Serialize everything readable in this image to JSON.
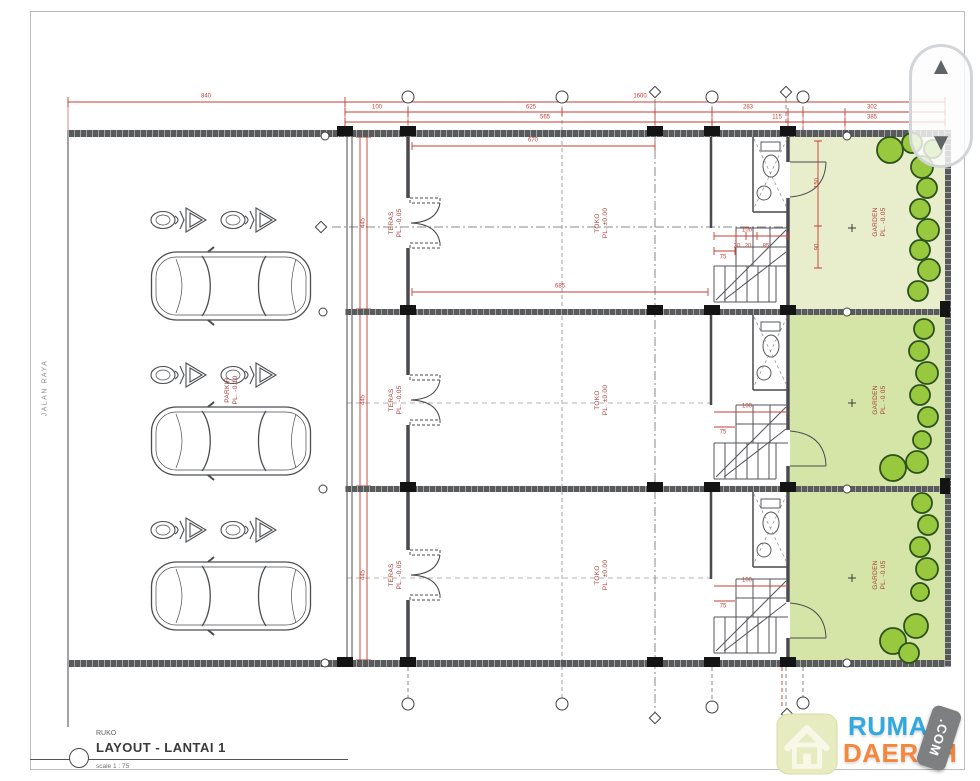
{
  "document": {
    "type": "architectural floor plan",
    "sheet_background": "#ffffff"
  },
  "scrollbar": {
    "up_icon": "▲",
    "down_icon": "▼"
  },
  "title_block": {
    "project": "RUKO",
    "title": "LAYOUT - LANTAI 1",
    "scale": "scale 1 : 75"
  },
  "logo": {
    "word1": "RUMAH",
    "word2": "DAERAH",
    "tag": ".COM",
    "colors": {
      "word1": "#31a9e0",
      "word2": "#f5863c",
      "tag_bg": "#7d7f80",
      "house_tile": "#e6ebc0"
    }
  },
  "plan": {
    "colors": {
      "wall": "#595a5c",
      "dimension_red": "#c43d33",
      "room_label_red": "#a8403a",
      "garden_light": "#e8eecb",
      "garden": "#d5e5a8",
      "bush_fill": "#97c83e",
      "bush_outline": "#2d521d"
    },
    "annotations": [
      {
        "name": "road-label",
        "cls": "road",
        "text": "JALAN RAYA",
        "x": 46,
        "y": 388,
        "rot": -90
      },
      {
        "name": "room-label-teras-1",
        "cls": "room",
        "text": "TERAS\nPL. -0.05",
        "x": 396,
        "y": 223,
        "rot": -90
      },
      {
        "name": "room-label-teras-2",
        "cls": "room",
        "text": "TERAS\nPL. -0.05",
        "x": 396,
        "y": 400,
        "rot": -90
      },
      {
        "name": "room-label-teras-3",
        "cls": "room",
        "text": "TERAS\nPL. -0.05",
        "x": 396,
        "y": 575,
        "rot": -90
      },
      {
        "name": "room-label-toko-1",
        "cls": "room",
        "text": "TOKO\nPL. ±0.00",
        "x": 602,
        "y": 223,
        "rot": -90
      },
      {
        "name": "room-label-toko-2",
        "cls": "room",
        "text": "TOKO\nPL. ±0.00",
        "x": 602,
        "y": 400,
        "rot": -90
      },
      {
        "name": "room-label-toko-3",
        "cls": "room",
        "text": "TOKO\nPL. ±0.00",
        "x": 602,
        "y": 575,
        "rot": -90
      },
      {
        "name": "room-label-garden-1",
        "cls": "room",
        "text": "GARDEN\nPL. -0.05",
        "x": 880,
        "y": 222,
        "rot": -90
      },
      {
        "name": "room-label-garden-2",
        "cls": "room",
        "text": "GARDEN\nPL. -0.05",
        "x": 880,
        "y": 400,
        "rot": -90
      },
      {
        "name": "room-label-garden-3",
        "cls": "room",
        "text": "GARDEN\nPL. -0.05",
        "x": 880,
        "y": 575,
        "rot": -90
      },
      {
        "name": "room-label-parkir",
        "cls": "room",
        "text": "PARKIR\nPL. -0.10",
        "x": 232,
        "y": 390,
        "rot": -90
      },
      {
        "name": "dim-840",
        "cls": "dim",
        "text": "840",
        "x": 206,
        "y": 97,
        "rot": 0
      },
      {
        "name": "dim-1600",
        "cls": "dim",
        "text": "1600",
        "x": 640,
        "y": 97,
        "rot": 0
      },
      {
        "name": "dim-100",
        "cls": "dim",
        "text": "100",
        "x": 377,
        "y": 108,
        "rot": 0
      },
      {
        "name": "dim-625",
        "cls": "dim",
        "text": "625",
        "x": 531,
        "y": 108,
        "rot": 0
      },
      {
        "name": "dim-283",
        "cls": "dim",
        "text": "283",
        "x": 748,
        "y": 108,
        "rot": 0
      },
      {
        "name": "dim-302",
        "cls": "dim",
        "text": "302",
        "x": 872,
        "y": 108,
        "rot": 0
      },
      {
        "name": "dim-565",
        "cls": "dim",
        "text": "565",
        "x": 545,
        "y": 118,
        "rot": 0
      },
      {
        "name": "dim-115",
        "cls": "dim",
        "text": "115",
        "x": 777,
        "y": 118,
        "rot": 0
      },
      {
        "name": "dim-385",
        "cls": "dim",
        "text": "385",
        "x": 872,
        "y": 118,
        "rot": 0
      },
      {
        "name": "dim-670",
        "cls": "dim",
        "text": "670",
        "x": 533,
        "y": 141,
        "rot": 0
      },
      {
        "name": "dim-685",
        "cls": "dim",
        "text": "685",
        "x": 560,
        "y": 287,
        "rot": 0
      },
      {
        "name": "dim-445-1",
        "cls": "dim",
        "text": "445",
        "x": 364,
        "y": 223,
        "rot": -90
      },
      {
        "name": "dim-445-2",
        "cls": "dim",
        "text": "445",
        "x": 364,
        "y": 400,
        "rot": -90
      },
      {
        "name": "dim-445-3",
        "cls": "dim",
        "text": "445",
        "x": 364,
        "y": 575,
        "rot": -90
      },
      {
        "name": "dim-stair1-100",
        "cls": "dim",
        "text": "100",
        "x": 747,
        "y": 231,
        "rot": 0
      },
      {
        "name": "dim-stair1-20a",
        "cls": "dim",
        "text": "20",
        "x": 737,
        "y": 247,
        "rot": 0
      },
      {
        "name": "dim-stair1-20b",
        "cls": "dim",
        "text": "20",
        "x": 748,
        "y": 247,
        "rot": 0
      },
      {
        "name": "dim-stair1-85",
        "cls": "dim",
        "text": "85",
        "x": 766,
        "y": 247,
        "rot": 0
      },
      {
        "name": "dim-stair1-75",
        "cls": "dim",
        "text": "75",
        "x": 723,
        "y": 258,
        "rot": 0
      },
      {
        "name": "dim-garden1-150",
        "cls": "dim",
        "text": "150",
        "x": 818,
        "y": 183,
        "rot": -90
      },
      {
        "name": "dim-garden1-90",
        "cls": "dim",
        "text": "90",
        "x": 818,
        "y": 247,
        "rot": -90
      },
      {
        "name": "dim-stair2-100",
        "cls": "dim",
        "text": "100",
        "x": 747,
        "y": 407,
        "rot": 0
      },
      {
        "name": "dim-stair2-75",
        "cls": "dim",
        "text": "75",
        "x": 723,
        "y": 433,
        "rot": 0
      },
      {
        "name": "dim-stair3-100",
        "cls": "dim",
        "text": "100",
        "x": 747,
        "y": 581,
        "rot": 0
      },
      {
        "name": "dim-stair3-75",
        "cls": "dim",
        "text": "75",
        "x": 723,
        "y": 607,
        "rot": 0
      }
    ],
    "grid_bubbles": [
      {
        "x": 408,
        "y": 97,
        "shape": "circle"
      },
      {
        "x": 562,
        "y": 97,
        "shape": "circle"
      },
      {
        "x": 712,
        "y": 97,
        "shape": "circle"
      },
      {
        "x": 803,
        "y": 97,
        "shape": "circle"
      },
      {
        "x": 655,
        "y": 92,
        "shape": "diamond"
      },
      {
        "x": 786,
        "y": 92,
        "shape": "diamond"
      },
      {
        "x": 408,
        "y": 704,
        "shape": "circle"
      },
      {
        "x": 562,
        "y": 704,
        "shape": "circle"
      },
      {
        "x": 712,
        "y": 707,
        "shape": "circle"
      },
      {
        "x": 803,
        "y": 703,
        "shape": "circle"
      },
      {
        "x": 655,
        "y": 718,
        "shape": "diamond"
      },
      {
        "x": 787,
        "y": 714,
        "shape": "diamond"
      },
      {
        "x": 321,
        "y": 227,
        "shape": "diamond"
      },
      {
        "x": 325,
        "y": 136,
        "shape": "circle-sm"
      },
      {
        "x": 323,
        "y": 312,
        "shape": "circle-sm"
      },
      {
        "x": 323,
        "y": 489,
        "shape": "circle-sm"
      },
      {
        "x": 325,
        "y": 663,
        "shape": "circle-sm"
      },
      {
        "x": 847,
        "y": 136,
        "shape": "circle-sm"
      },
      {
        "x": 847,
        "y": 312,
        "shape": "circle-sm"
      },
      {
        "x": 847,
        "y": 489,
        "shape": "circle-sm"
      },
      {
        "x": 847,
        "y": 663,
        "shape": "circle-sm"
      }
    ]
  }
}
